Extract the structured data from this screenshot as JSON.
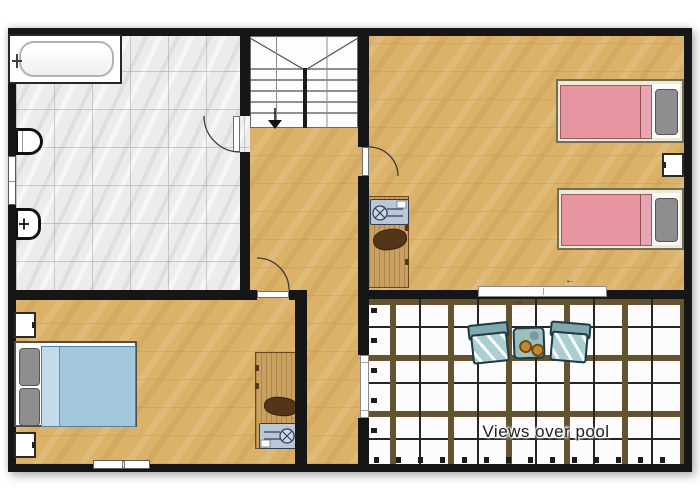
{
  "annotation": {
    "text": "Views over pool"
  },
  "icons": {
    "slide_left": "←",
    "slide_right": "→",
    "stairs_down": "▼"
  },
  "rooms": [
    "bathroom",
    "staircase",
    "hallway",
    "twin-bedroom",
    "double-bedroom",
    "roof-terrace"
  ],
  "furniture": [
    "bathtub",
    "toilet",
    "bidet",
    "single-bed-1",
    "single-bed-2",
    "twin-nightstand",
    "double-bed",
    "nightstand-top",
    "nightstand-bottom",
    "desk-twin-room",
    "desk-double-room",
    "office-chair-1",
    "office-chair-2",
    "laptop-1",
    "laptop-2",
    "terrace-chair-1",
    "terrace-chair-2",
    "terrace-table",
    "two-cups"
  ],
  "openings": [
    "bathroom-door",
    "twin-bedroom-door",
    "double-bedroom-door",
    "terrace-sliding-door",
    "hall-terrace-door",
    "bathroom-window",
    "bedroom-window"
  ],
  "colors": {
    "wall": "#161616",
    "wood_floor": "#dcb269",
    "tile_floor": "#ececec",
    "terrace_beam": "#63532e",
    "terrace_line": "#262626",
    "bed_pink": "#e796a1",
    "bed_blue": "#a2c6da",
    "frame_cream": "#f0ead4",
    "pillow_gray": "#8e8e8e",
    "desk_wood": "#c9a05f",
    "chair_brown": "#53361a",
    "laptop_gray": "#b9c7d7",
    "terrace_chair": "#aacfd2",
    "terrace_chair_back": "#7fa9ad",
    "terrace_table": "#9dbfc0",
    "cup_orange": "#c28a2e",
    "label_text": "#1f1f1f"
  }
}
